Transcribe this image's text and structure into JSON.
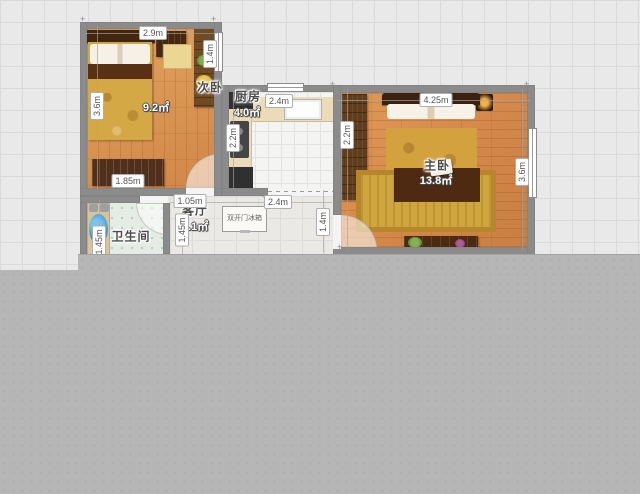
{
  "plan": {
    "rooms": {
      "secondary_bedroom": {
        "name": "次卧",
        "area": "9.2㎡"
      },
      "kitchen": {
        "name": "厨房",
        "area": "4.0㎡"
      },
      "master_bedroom": {
        "name": "主卧",
        "area": "13.8㎡"
      },
      "bathroom": {
        "name": "卫生间"
      },
      "living_room": {
        "name": "客厅",
        "area": "35.1㎡"
      }
    },
    "dimensions": {
      "sb_top": "2.9m",
      "sb_window": "1.4m",
      "sb_left": "3.6m",
      "sb_dresser": "1.85m",
      "kitchen_top": "2.4m",
      "kitchen_left": "2.2m",
      "living_kitchen": "2.4m",
      "corridor": "1.05m",
      "bath_left": "1.45m",
      "bath_right": "1.45m",
      "living_master": "1.4m",
      "mb_top": "4.25m",
      "mb_left": "2.2m",
      "mb_right": "3.6m"
    },
    "furniture": {
      "fridge_label": "双开门冰箱"
    },
    "colors": {
      "wall": "#8b8b8b",
      "wood_floor": "#d78d4e",
      "slab": "#b6b6b6",
      "canvas_grid": "#e9e9e9",
      "sink_blue": "#2f86c0",
      "bedding_gold": "#d4a945"
    }
  }
}
